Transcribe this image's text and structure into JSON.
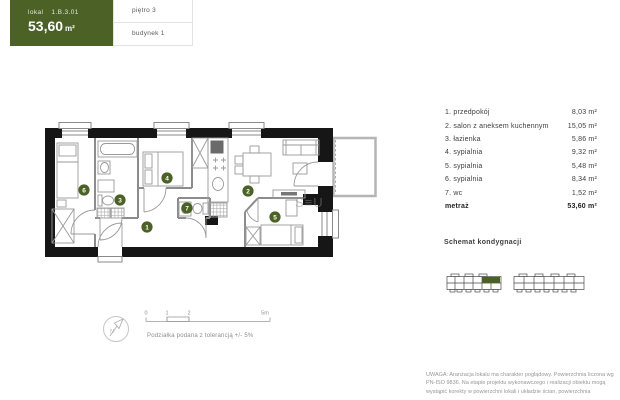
{
  "header": {
    "lokal_label": "lokal",
    "lokal_id": "1.B.3.01",
    "area_value": "53,60",
    "area_unit": "m²",
    "floor": "piętro 3",
    "building": "budynek 1"
  },
  "colors": {
    "accent": "#4b6125",
    "wall": "#161616"
  },
  "rooms": [
    {
      "number": "1",
      "name": "przedpokój",
      "area": "8,03 m²"
    },
    {
      "number": "2",
      "name": "salon z aneksem kuchennym",
      "area": "15,05 m²"
    },
    {
      "number": "3",
      "name": "łazienka",
      "area": "5,86 m²"
    },
    {
      "number": "4",
      "name": "sypialnia",
      "area": "9,32 m²"
    },
    {
      "number": "5",
      "name": "sypialnia",
      "area": "5,48 m²"
    },
    {
      "number": "6",
      "name": "sypialnia",
      "area": "8,34 m²"
    },
    {
      "number": "7",
      "name": "wc",
      "area": "1,52 m²"
    }
  ],
  "total": {
    "label": "metraż",
    "area": "53,60 m²"
  },
  "schemat_title": "Schemat kondygnacji",
  "scale": {
    "ticks": [
      "0",
      "1",
      "2",
      "5m"
    ],
    "note": "Podziałka podana z tolerancją +/- 5%"
  },
  "compass_label": "N",
  "plan_watermark": "S≡U",
  "disclaimer": "UWAGA: Aranżacja lokalu ma charakter poglądowy. Powierzchnia liczona wg PN-ISO 9836. Na etapie projektu wykonawczego i realizacji obiektu mogą wystąpić korekty w powierzchni lokali i układzie ścian, powierzchnia"
}
